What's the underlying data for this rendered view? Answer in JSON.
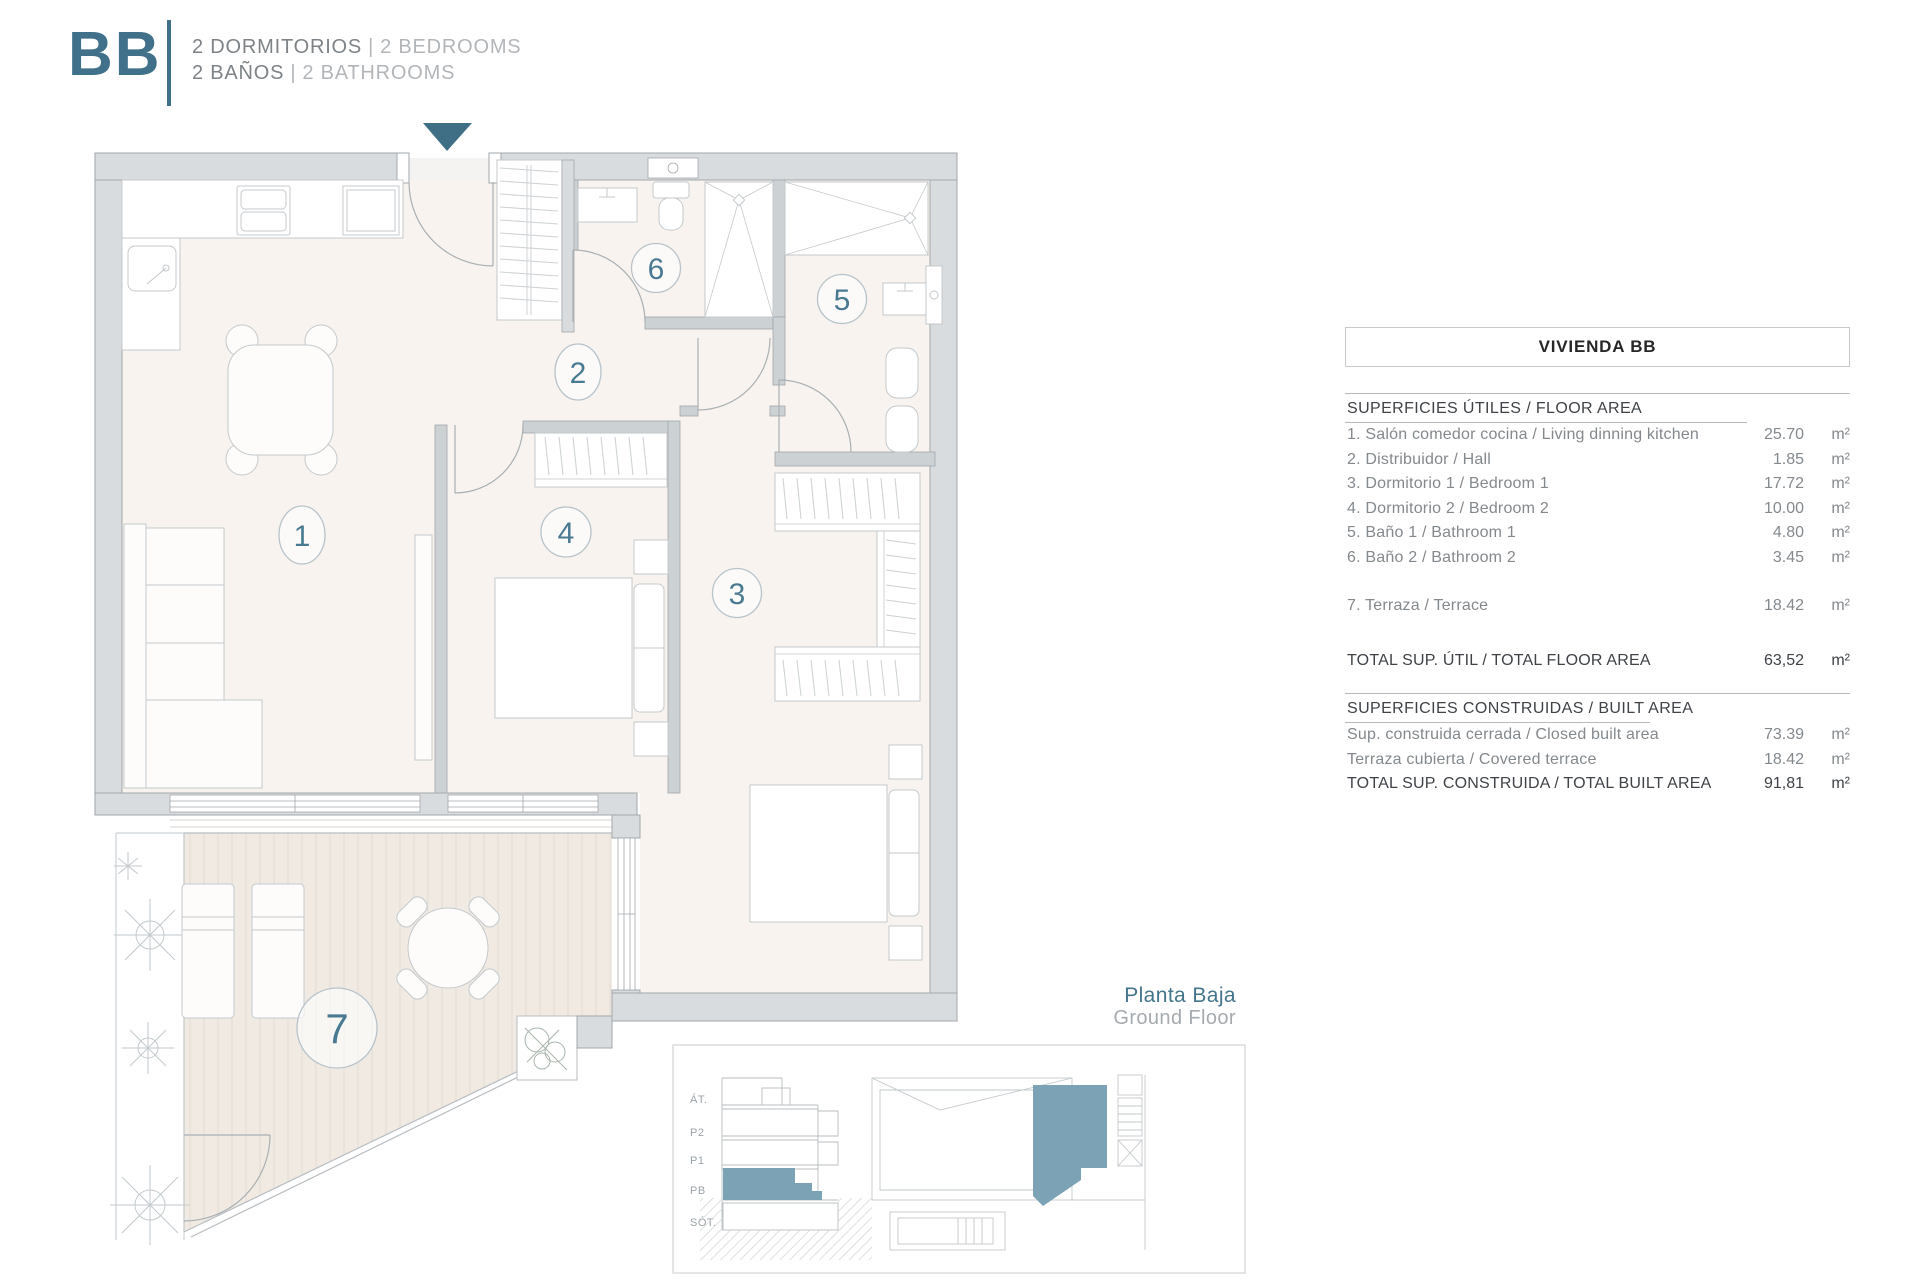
{
  "header": {
    "logo": "BB",
    "line1_primary": "2 DORMITORIOS",
    "line1_sep": "|",
    "line1_secondary": "2 BEDROOMS",
    "line2_primary": "2 BAÑOS",
    "line2_sep": "|",
    "line2_secondary": "2 BATHROOMS"
  },
  "plan": {
    "room_numbers": [
      "1",
      "2",
      "3",
      "4",
      "5",
      "6",
      "7"
    ]
  },
  "area_table": {
    "title": "VIVIENDA BB",
    "sections": [
      {
        "header": "SUPERFICIES ÚTILES / FLOOR AREA",
        "rows": [
          {
            "label": "1. Salón comedor cocina / Living dinning kitchen",
            "value": "25.70",
            "unit": "m²"
          },
          {
            "label": "2. Distribuidor / Hall",
            "value": "1.85",
            "unit": "m²"
          },
          {
            "label": "3. Dormitorio 1 / Bedroom 1",
            "value": "17.72",
            "unit": "m²"
          },
          {
            "label": "4. Dormitorio 2 / Bedroom 2",
            "value": "10.00",
            "unit": "m²"
          },
          {
            "label": "5. Baño 1 / Bathroom 1",
            "value": "4.80",
            "unit": "m²"
          },
          {
            "label": "6. Baño 2 / Bathroom 2",
            "value": "3.45",
            "unit": "m²"
          },
          {
            "label": "7. Terraza / Terrace",
            "value": "18.42",
            "unit": "m²"
          }
        ],
        "total": {
          "label": "TOTAL SUP. ÚTIL / TOTAL FLOOR AREA",
          "value": "63,52",
          "unit": "m²"
        }
      },
      {
        "header": "SUPERFICIES CONSTRUIDAS / BUILT AREA",
        "rows": [
          {
            "label": "Sup. construida cerrada / Closed built area",
            "value": "73.39",
            "unit": "m²"
          },
          {
            "label": "Terraza cubierta / Covered terrace",
            "value": "18.42",
            "unit": "m²"
          }
        ],
        "total": {
          "label": "TOTAL SUP. CONSTRUIDA /  TOTAL BUILT AREA",
          "value": "91,81",
          "unit": "m²"
        }
      }
    ]
  },
  "floor_caption": {
    "primary": "Planta Baja",
    "secondary": "Ground Floor"
  },
  "mini_diagram": {
    "levels": [
      "ÁT.",
      "P2",
      "P1",
      "PB",
      "SÓT."
    ]
  },
  "colors": {
    "teal": "#41708a",
    "teal_number": "#4a7a91",
    "teal_fill": "#7ba2b5",
    "wall_gray": "#d9dcde",
    "floor": "#f8f3ee",
    "deck": "#f1eae3"
  }
}
